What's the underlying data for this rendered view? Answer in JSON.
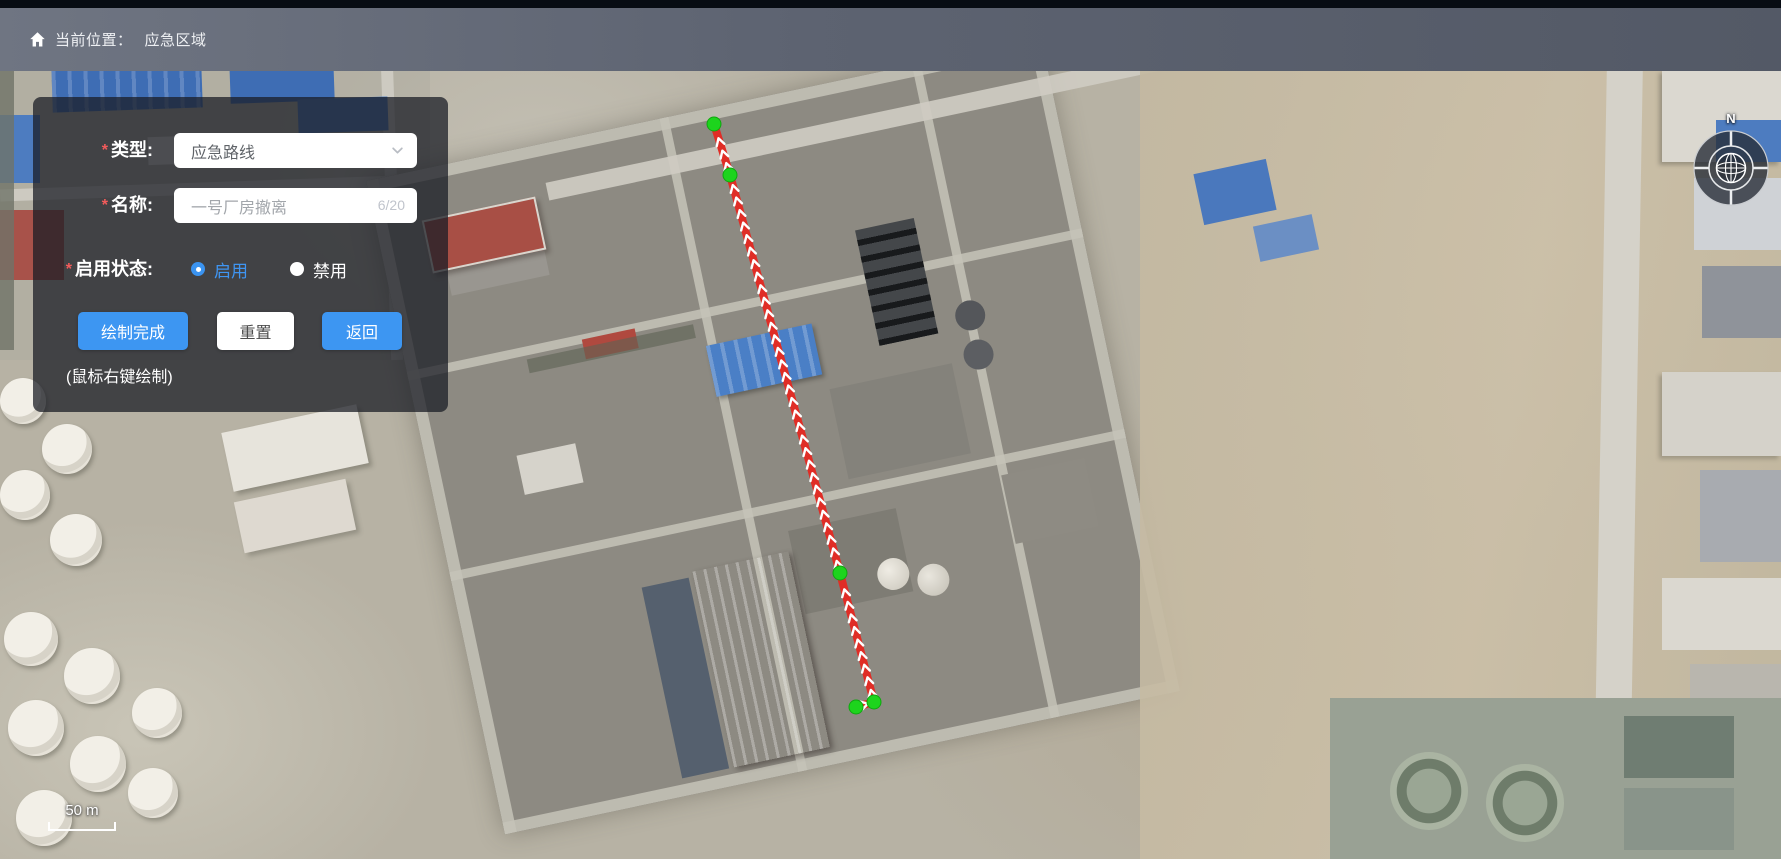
{
  "header": {
    "breadcrumb_label": "当前位置：",
    "breadcrumb_value": "应急区域"
  },
  "panel": {
    "required_mark": "*",
    "type_field": {
      "label": "类型:",
      "value": "应急路线"
    },
    "name_field": {
      "label": "名称:",
      "value": "一号厂房撤离",
      "counter": "6/20"
    },
    "status_field": {
      "label": "启用状态:",
      "options": [
        {
          "label": "启用",
          "selected": true
        },
        {
          "label": "禁用",
          "selected": false
        }
      ]
    },
    "buttons": {
      "finish": "绘制完成",
      "reset": "重置",
      "back": "返回"
    },
    "hint": "(鼠标右键绘制)"
  },
  "map": {
    "compass_label": "N",
    "scale_label": "50 m",
    "route": {
      "color": "#e02d26",
      "arrow_color": "#ffffff",
      "vertex_color": "#1dd41d",
      "vertex_stroke": "#0fa70f",
      "points": [
        [
          856,
          707
        ],
        [
          874,
          702
        ],
        [
          840,
          573
        ],
        [
          730,
          175
        ],
        [
          714,
          124
        ]
      ]
    }
  },
  "colors": {
    "accent_blue": "#3d96f2",
    "radio_selected": "#3a93f0",
    "required_red": "#f45b5b",
    "header_bar": "#5d6371"
  }
}
